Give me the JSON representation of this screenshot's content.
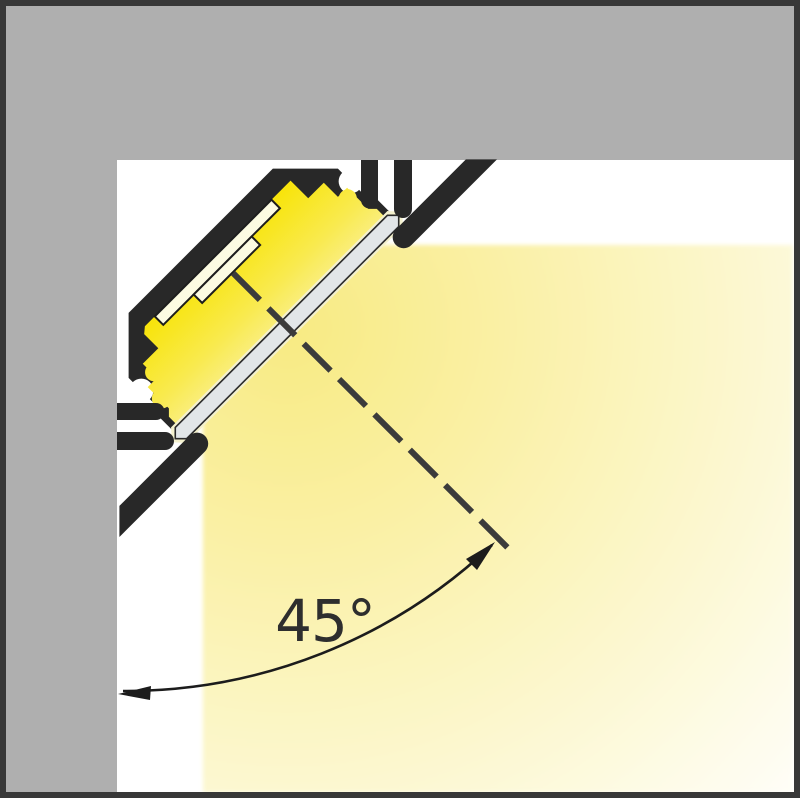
{
  "diagram": {
    "type": "led-profile-corner-mount-cross-section",
    "angle_label": "45°",
    "angle_value_degrees": 45,
    "parts": [
      "ceiling-surface",
      "wall-surface",
      "aluminium-profile-body",
      "led-strip-pcb",
      "led-module",
      "diffuser-cover",
      "mounting-fins",
      "trim-flanges",
      "light-beam",
      "beam-axis-centerline",
      "angle-dimension-arc"
    ]
  },
  "colors": {
    "background": "#FFFFFF",
    "frame": "#383838",
    "wall_gray": "#AFAFAF",
    "profile_black": "#282828",
    "cavity_yellow": "#F8E40A",
    "cavity_yellow_light": "#FAF19E",
    "led_strip_cream": "#FCFBE2",
    "led_strip_outline": "#1D1D1D",
    "diffuser_gray": "#E2E6E8",
    "diffuser_halo": "#F4F1CE",
    "diffuser_outline": "#2B2B2B",
    "beam_yellow": "#F8EA82",
    "beam_yellow_mid": "#FAF1A8",
    "dash_line": "#3B3B3B",
    "arc_line": "#1C1C1C",
    "label_text": "#2E2E2E"
  }
}
